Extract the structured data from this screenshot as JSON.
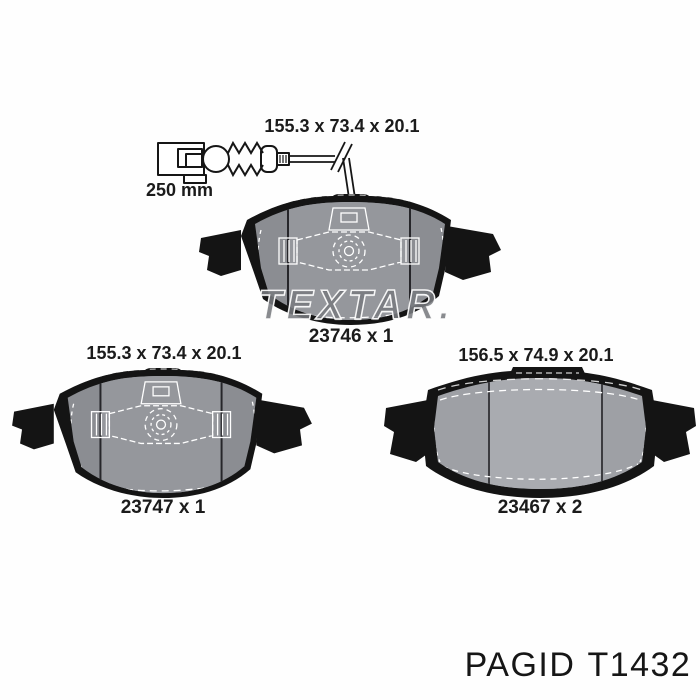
{
  "image": {
    "description": "Brake pad set technical product illustration with wear sensor",
    "background": "#fefefe"
  },
  "watermark": {
    "text": "TEXTAR."
  },
  "sensor": {
    "length_label": "250 mm"
  },
  "pads": [
    {
      "dimensions_label": "155.3 x 73.4 x 20.1",
      "part_label": "23746 x 1",
      "has_wear_sensor": true
    },
    {
      "dimensions_label": "155.3 x 73.4 x 20.1",
      "part_label": "23747 x 1",
      "has_wear_sensor": false
    },
    {
      "dimensions_label": "156.5 x 74.9 x 20.1",
      "part_label": "23467 x 2",
      "has_wear_sensor": false
    }
  ],
  "footer": {
    "brand": "PAGID",
    "part_code": "T1432"
  },
  "colors": {
    "text": "#1b1b1b",
    "pad_black": "#141414",
    "pad_face_outer": "#8b8d92",
    "pad_face_middle": "#95979c",
    "pad3_face_outer": "#9ea0a5",
    "pad3_face_middle": "#a9abb0",
    "overlay_white": "#ffffff",
    "watermark_gray": "rgba(92,94,100,0.72)"
  }
}
